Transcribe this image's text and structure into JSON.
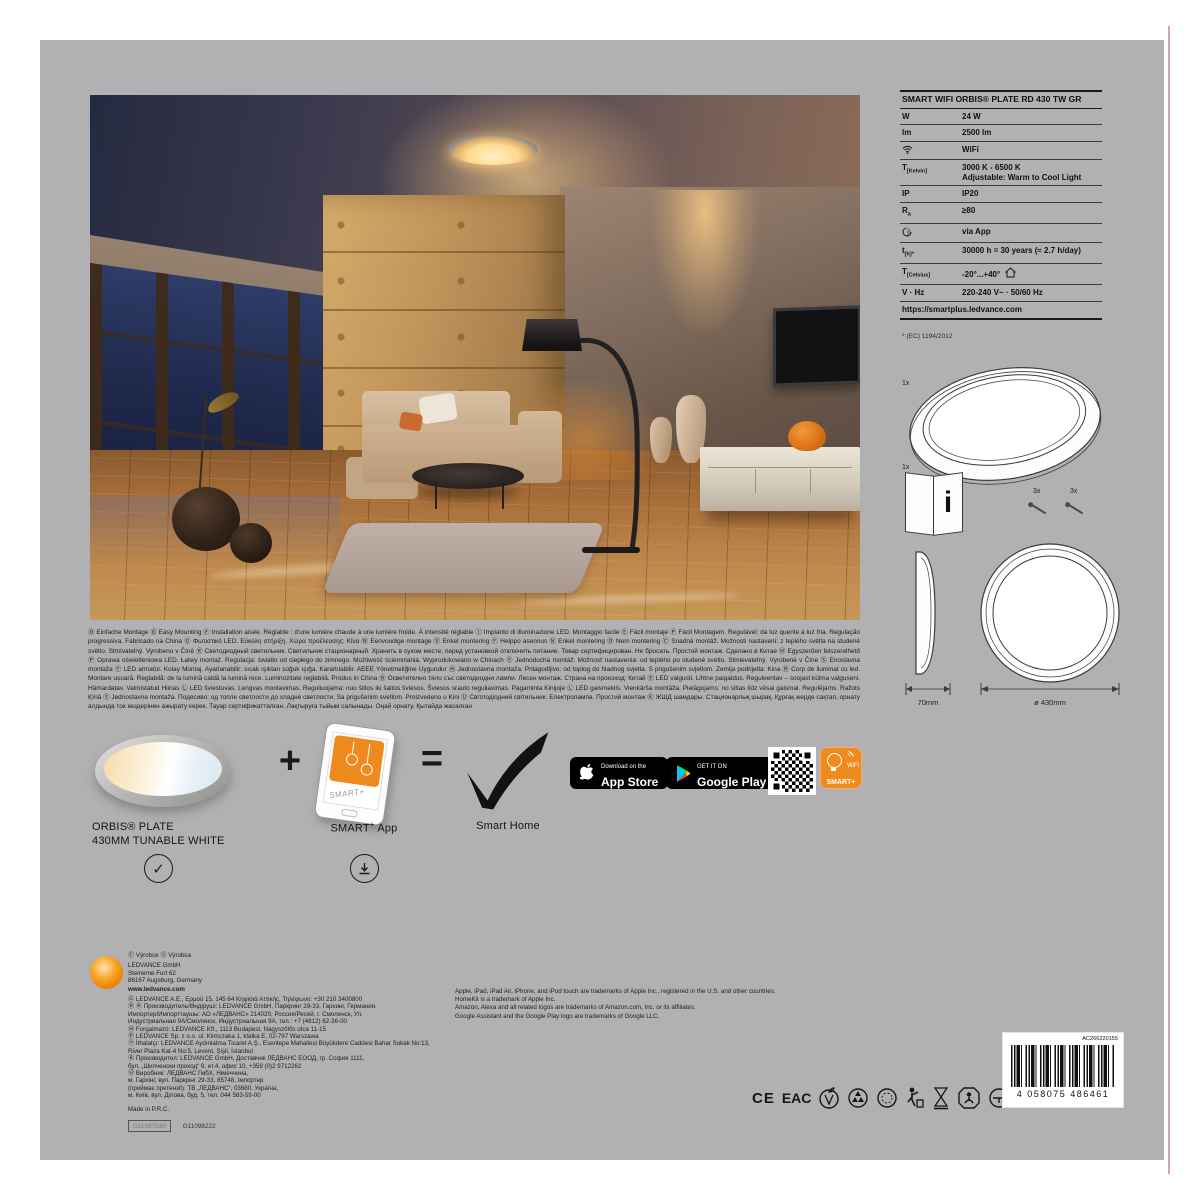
{
  "spec": {
    "title": "SMART WIFI ORBIS® PLATE RD 430 TW GR",
    "rows": [
      {
        "label": "W",
        "sub": "",
        "value": "24 W"
      },
      {
        "label": "lm",
        "sub": "",
        "value": "2500 lm"
      },
      {
        "label": "",
        "sub": "",
        "value": "WiFi"
      },
      {
        "label": "T",
        "sub": "[Kelvin]",
        "value": "3000 K - 6500 K",
        "value2": "Adjustable: Warm to Cool Light"
      },
      {
        "label": "IP",
        "sub": "",
        "value": "IP20"
      },
      {
        "label": "R",
        "sub": "a",
        "value": "≥80"
      },
      {
        "label": "",
        "sub": "",
        "value": "via App"
      },
      {
        "label": "t",
        "sub": "[h]*",
        "value": "30000 h = 30 years (≈ 2.7 h/day)"
      },
      {
        "label": "T",
        "sub": "[Celsius]",
        "value": "-20°...+40°"
      },
      {
        "label": "V · Hz",
        "sub": "",
        "value": "220-240 V~ · 50/60 Hz"
      }
    ],
    "link": "https://smartplus.ledvance.com",
    "footnote": "* (EC) 1194/2012"
  },
  "contents": {
    "lamp_qty": "1x",
    "manual_qty": "1x",
    "screws_qty1": "3x",
    "screws_qty2": "3x",
    "info_letter": "i",
    "depth_label": "70mm",
    "diameter_label": "ø 430mm"
  },
  "multilang": "Ⓓ Einfache Montage Ⓖ Easy Mounting Ⓕ Installation aisée. Réglable : d'une lumière chaude à une lumière froide. À intensité réglable Ⓘ Impianto di illuminazione LED. Montaggio facile Ⓔ Fácil montaje Ⓟ Fácil Montagem. Regulável: da luz quente à luz fria. Regulação progressiva. Fabricado na China Ⓖ Φωτιστικό LED. Εύκολη στήριξη. Χώρα προέλευσης: Κίνα Ⓝ Eenvoudige montage Ⓢ Enkel montering Ⓕ Helppo asennus Ⓝ Enkel montering Ⓓ Nem montering Ⓒ Snadná montáž. Možnosti nastavení: z teplého světla na studené světlo. Stmívatelný. Vyrobeno v Číně Ⓡ Светодиодный светильник. Светильник стационарный. Хранить в сухом месте, перед установкой отключить питание. Товар сертифицирован. Не бросать. Простой монтаж. Сделано в Китае Ⓗ Egyszerűen felszerelhető Ⓟ Oprawa oświetleniowa LED. Łatwy montaż. Regulacja: światło od ciepłego do zimnego. Możliwość ściemniania. Wyprodukowano w Chinach Ⓢ Jednoduchá montáž. Možnosť nastavenia: od teplého po studené svetlo. Stmievateľný. Vyrobené v Číne Ⓢ Enostavna montaža Ⓣ LED armatür. Kolay Montaj. Ayarlanabilir: sıcak ışıktan soğuk ışığa. Karartılabilir. AEEE Yönetmeliğine Uygundur Ⓗ Jednostavna montaža. Prilagodljivo: od toplog do hladnog svjetla. S prigušenim svjetlom. Zemlja podrijetla: Kina Ⓡ Corp de iluminat cu led. Montare ușoară. Reglabilă: de la lumină caldă la lumină rece. Luminozitate reglabilă. Produs in China Ⓑ Осветително тяло със светодиодни лампи. Лесен монтаж. Страна на произход: Китай Ⓔ LED valgusti. Lihtne paigaldus. Reguleeritav – soojast külma valguseni. Hämardatav. Valmistatud Hiinas Ⓛ LED šviestuvas. Lengvas montavimas. Reguliuojama: nuo šiltos iki šaltos šviesos. Šviesos srauto reguliavimas. Pagaminta Kinijoje Ⓛ LED gaismeklis. Vienkārša montāža. Pielāgojams: no siltas līdz vēsai gaismai. Regulējams. Ražots Ķīnā Ⓢ Jednostavna montaža. Подесиво: од топле светлости до хладне светлости. Sa prigušenim svetlom. Proizvedeno u Kini Ⓤ Світлодіодний світильник. Електролампа. Простий монтаж Ⓚ ЖШД шамдары. Стационарлық шырақ. Құрғақ жерде сақтап, орнату алдында ток көздерінен ажырату керек. Тауар сертификатталған. Лақтыруға тыйым салынады. Оңай орнату. Қытайда жасалған",
  "formula": {
    "plus": "+",
    "equals": "=",
    "product_line1": "ORBIS® PLATE",
    "product_line2": "430MM TUNABLE WHITE",
    "app_brand": "SMART",
    "app_sup": "+",
    "app_word": " App",
    "result": "Smart Home",
    "phone_screen_text": "SMART+"
  },
  "badges": {
    "appstore_tag": "Download on the",
    "appstore_name": "App Store",
    "gplay_tag": "GET IT ON",
    "gplay_name": "Google Play",
    "smart_wifi": "WiFi",
    "smart_name": "SMART+"
  },
  "footer": {
    "producers": "Ⓒ Výrobce    Ⓢ Výrobca",
    "company": "LEDVANCE GmbH\nSteinerne Furt 62\n86167 Augsburg, Germany",
    "website": "www.ledvance.com",
    "distributors": "Ⓖ LEDVANCE A.E., Ερμού 15, 145 64 Κηφισιά Αττικής, Τηλέφωνο: +30 210 3400800\nⓇ Ⓚ Производитель/Өндіруші: LEDVANCE GmbH, Паркринг 29-33, Гархинг, Германия.\nИмпортер/Импорттаушы: АО «ЛЕДВАНС» 214020, Россия/Ресей, г. Смоленск, Ул.\nИндустриальная 9А/Смоленск, Индустриальная 9А, тел.: +7 (4812) 62-36-00\nⒽ Forgalmazó: LEDVANCE Kft., 1113 Budapest, Nagyszőlős utca 11-15\nⓅ LEDVANCE Sp. z o.o. ul. Klimczaka 1, klatka E, 02-797 Warszawa\nⓉ İthalatçı: LEDVANCE Aydınlatma Ticaret A.Ş., Esentepe Mahallesi Büyükdere Caddesi Bahar Sokak No:13,\nRiver Plaza Kat-4 No:5, Levent, Şişli, İstanbul\nⒷ Производител: LEDVANCE GmbH, Доставчик ЛЕДВАНС ЕООД, гр. София 1111,\nбул. „Шипченски проход“ 9, ет.4, офис 10, +359 (0)2 9712262\nⓊ Виробник: ЛЕДВАНС ГмбХ, Німеччина,\nм. Гархінг, вул. Паркрінг 29-33, 85748, Імпортер\n(приймає претензії): ТВ „ЛЕДВАНС“, 03680, Україна,\nм. Київ, вул. Ділова, буд. 5, тел. 044 583-59-00",
    "made_in": "Made in P.R.C.",
    "code_boxed": "G11097930",
    "code_plain": "G11098222",
    "trademarks": "Apple, iPad, iPad Air, iPhone, and iPod touch are trademarks of Apple Inc., registered in the U.S. and other countries. HomeKit is a trademark of Apple Inc.\nAmazon, Alexa and all related logos are trademarks of Amazon.com, Inc. or its affiliates.\nGoogle Assistant and the Google Play logo are trademarks of Google LLC."
  },
  "certs": {
    "ce": "CE",
    "eac": "EAC",
    "rohs": "RoHS"
  },
  "barcode": {
    "label": "AC266220155",
    "number": "4 058075 486461"
  },
  "colors": {
    "brand_orange": "#ef8a1e",
    "panel_gray": "#b1b1b3"
  }
}
